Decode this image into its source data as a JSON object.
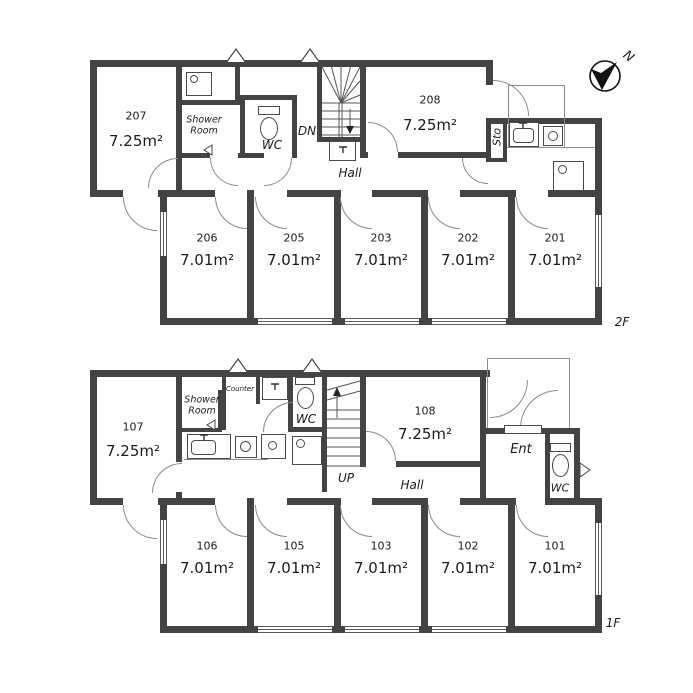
{
  "compass": {
    "label": "N"
  },
  "floor2": {
    "floor_label": "2F",
    "rooms": {
      "r207": {
        "number": "207",
        "area": "7.25m²"
      },
      "r208": {
        "number": "208",
        "area": "7.25m²"
      },
      "r206": {
        "number": "206",
        "area": "7.01m²"
      },
      "r205": {
        "number": "205",
        "area": "7.01m²"
      },
      "r203": {
        "number": "203",
        "area": "7.01m²"
      },
      "r202": {
        "number": "202",
        "area": "7.01m²"
      },
      "r201": {
        "number": "201",
        "area": "7.01m²"
      }
    },
    "labels": {
      "shower_room": "Shower\nRoom",
      "wc": "WC",
      "stairs": "DN",
      "hall": "Hall",
      "storage": "Sto"
    }
  },
  "floor1": {
    "floor_label": "1F",
    "rooms": {
      "r107": {
        "number": "107",
        "area": "7.25m²"
      },
      "r108": {
        "number": "108",
        "area": "7.25m²"
      },
      "r106": {
        "number": "106",
        "area": "7.01m²"
      },
      "r105": {
        "number": "105",
        "area": "7.01m²"
      },
      "r103": {
        "number": "103",
        "area": "7.01m²"
      },
      "r102": {
        "number": "102",
        "area": "7.01m²"
      },
      "r101": {
        "number": "101",
        "area": "7.01m²"
      }
    },
    "labels": {
      "shower_room": "Shower\nRoom",
      "counter": "Counter",
      "wc": "WC",
      "stairs": "UP",
      "hall": "Hall",
      "entrance": "Ent",
      "wc2": "WC"
    }
  }
}
